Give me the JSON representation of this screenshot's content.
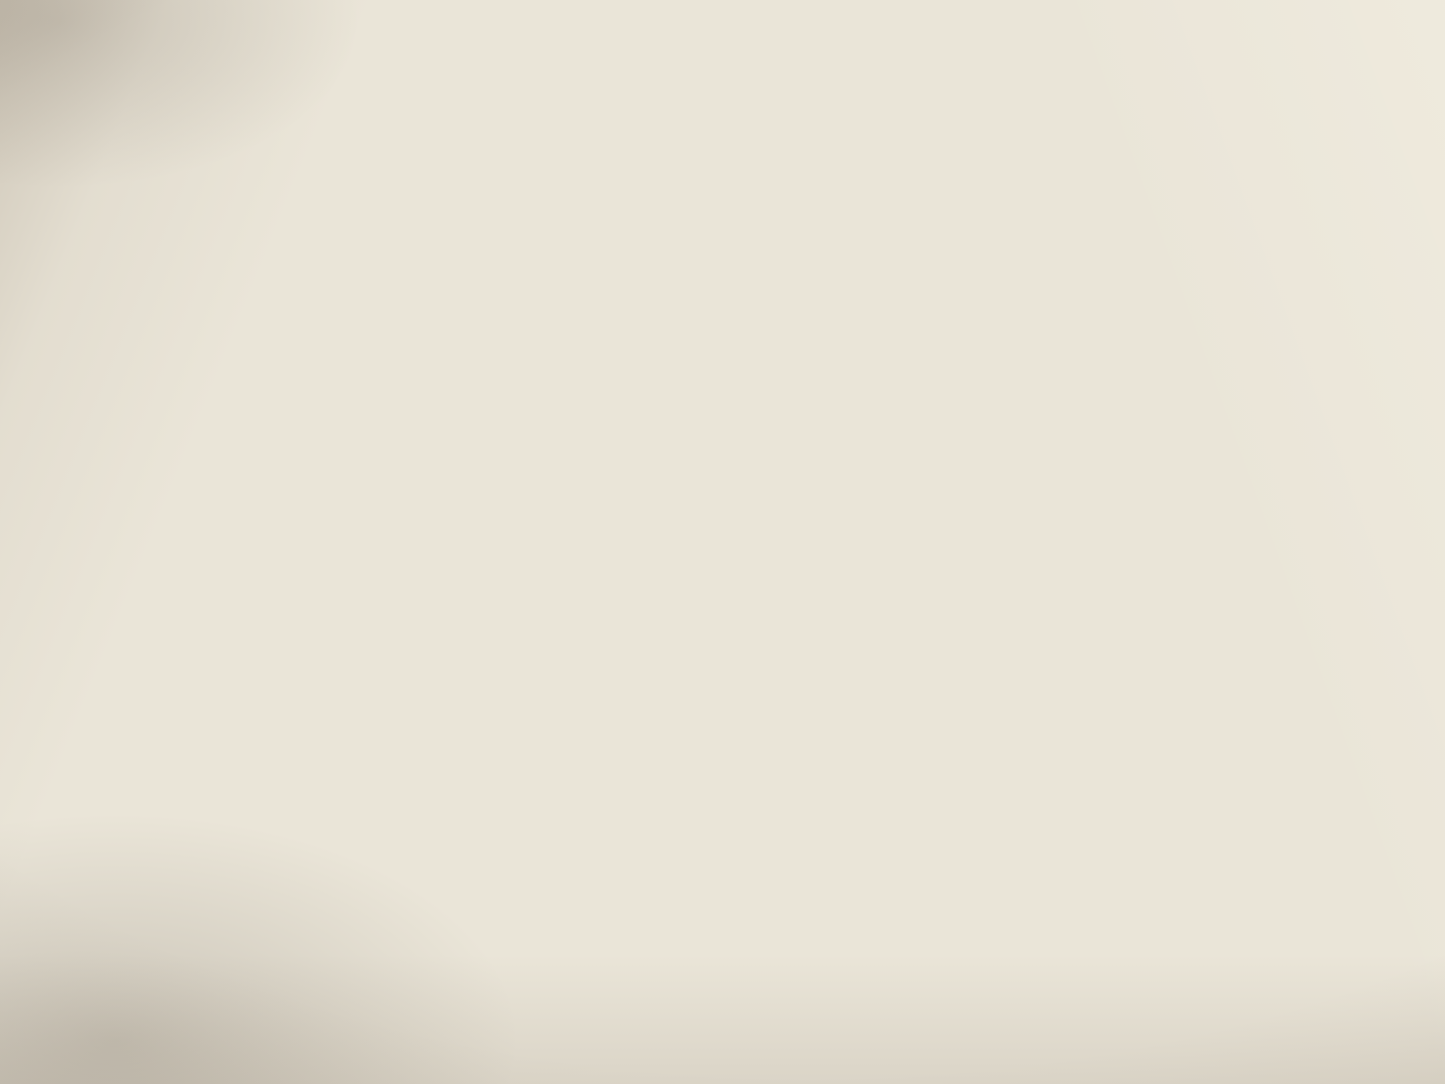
{
  "palette": {
    "paper": "#eae5d8",
    "ink": "#2b2722",
    "contour": "#9d5c3a",
    "contour_light": "#b98e6a",
    "water": "#46719c",
    "water_fill": "#a3bed2",
    "elevation_red": "#93401f"
  },
  "map": {
    "type": "topographic-quadrangle",
    "city_name": "MACOMB",
    "labels": [
      {
        "id": "township-letter-m1",
        "kind": "township",
        "text": "M",
        "x": 41,
        "y": 138,
        "size": 62
      },
      {
        "id": "township-letter-m2",
        "kind": "township",
        "text": "M",
        "x": 194,
        "y": 142,
        "size": 62
      },
      {
        "id": "township-letter-e",
        "kind": "township",
        "text": "E",
        "x": 350,
        "y": 139,
        "size": 60
      },
      {
        "id": "township-letter-t",
        "kind": "township",
        "text": "T",
        "x": 503,
        "y": 136,
        "size": 62
      },
      {
        "id": "township-letter-m3",
        "kind": "township",
        "text": "M",
        "x": 1016,
        "y": 176,
        "size": 64
      },
      {
        "id": "township-letter-a",
        "kind": "township",
        "text": "A",
        "x": 1224,
        "y": 179,
        "size": 64
      },
      {
        "id": "township-letter-c",
        "kind": "township",
        "text": "C",
        "x": 1432,
        "y": 181,
        "size": 64
      },
      {
        "id": "section-27",
        "kind": "section",
        "text": "27",
        "x": 70,
        "y": 202,
        "size": 29
      },
      {
        "id": "section-26",
        "kind": "section",
        "text": "26",
        "x": 274,
        "y": 188,
        "size": 29
      },
      {
        "id": "section-25",
        "kind": "section",
        "text": "25",
        "x": 609,
        "y": 212,
        "size": 29
      },
      {
        "id": "section-30",
        "kind": "section",
        "text": "30",
        "x": 871,
        "y": 211,
        "size": 29
      },
      {
        "id": "section-29",
        "kind": "section",
        "text": "29",
        "x": 1135,
        "y": 208,
        "size": 29
      },
      {
        "id": "section-28",
        "kind": "section",
        "text": "28",
        "x": 1418,
        "y": 217,
        "size": 29
      },
      {
        "id": "section-34",
        "kind": "section",
        "text": "34",
        "x": 27,
        "y": 490,
        "size": 29
      },
      {
        "id": "section-35",
        "kind": "section",
        "text": "35",
        "x": 283,
        "y": 494,
        "size": 29
      },
      {
        "id": "section-36",
        "kind": "section",
        "text": "36",
        "x": 535,
        "y": 508,
        "size": 29
      },
      {
        "id": "section-32",
        "kind": "section",
        "text": "32",
        "x": 1155,
        "y": 475,
        "size": 29
      },
      {
        "id": "section-33",
        "kind": "section",
        "text": "33",
        "x": 1398,
        "y": 481,
        "size": 29
      },
      {
        "id": "section-3",
        "kind": "section",
        "text": "3",
        "x": 13,
        "y": 740,
        "size": 29
      },
      {
        "id": "section-2",
        "kind": "section",
        "text": "2",
        "x": 308,
        "y": 742,
        "size": 29
      },
      {
        "id": "section-1",
        "kind": "section",
        "text": "1",
        "x": 571,
        "y": 751,
        "size": 29
      },
      {
        "id": "section-6",
        "kind": "section",
        "text": "6",
        "x": 884,
        "y": 747,
        "size": 29
      },
      {
        "id": "section-5",
        "kind": "section",
        "text": "5",
        "x": 1148,
        "y": 750,
        "size": 29
      },
      {
        "id": "section-4",
        "kind": "section",
        "text": "4",
        "x": 1417,
        "y": 725,
        "size": 29
      },
      {
        "id": "section-10",
        "kind": "section",
        "text": "10",
        "x": 47,
        "y": 1018,
        "size": 27
      },
      {
        "id": "section-11",
        "kind": "section",
        "text": "11",
        "x": 308,
        "y": 1036,
        "size": 27
      },
      {
        "id": "section-12",
        "kind": "section",
        "text": "12",
        "x": 592,
        "y": 1038,
        "size": 27
      },
      {
        "id": "section-7",
        "kind": "section",
        "text": "7",
        "x": 870,
        "y": 1015,
        "size": 27
      },
      {
        "id": "section-8",
        "kind": "section",
        "text": "8",
        "x": 1143,
        "y": 1022,
        "size": 27
      },
      {
        "id": "section-9",
        "kind": "section",
        "text": "9",
        "x": 1408,
        "y": 1018,
        "size": 27
      },
      {
        "id": "elevation-717",
        "kind": "elev-red",
        "text": "717",
        "x": 477,
        "y": 60,
        "size": 20
      },
      {
        "id": "elevation-653",
        "kind": "elev-red",
        "text": "653",
        "x": 755,
        "y": 70,
        "size": 20
      },
      {
        "id": "elevation-700-ne",
        "kind": "elev-red",
        "text": "700",
        "x": 1283,
        "y": 96,
        "size": 20
      },
      {
        "id": "elevation-600-pond",
        "kind": "elev-red",
        "text": "600",
        "x": 875,
        "y": 155,
        "size": 19
      },
      {
        "id": "elevation-700-hill",
        "kind": "elev-red",
        "text": "700",
        "x": 1096,
        "y": 192,
        "size": 19
      },
      {
        "id": "elevation-600-creek",
        "kind": "elev-red",
        "text": "600",
        "x": 296,
        "y": 282,
        "size": 19
      },
      {
        "id": "elevation-679-n",
        "kind": "elev-red",
        "text": "679",
        "x": 826,
        "y": 300,
        "size": 19
      },
      {
        "id": "elevation-700-w",
        "kind": "elev-red",
        "text": "700",
        "x": 38,
        "y": 300,
        "size": 19,
        "rot": -70
      },
      {
        "id": "elevation-694",
        "kind": "elev-red",
        "text": "694",
        "x": 1291,
        "y": 542,
        "size": 19
      },
      {
        "id": "elevation-700-sw",
        "kind": "elev-red",
        "text": "700",
        "x": 492,
        "y": 589,
        "size": 19,
        "rot": -48
      },
      {
        "id": "elevation-687",
        "kind": "elev-red",
        "text": "687",
        "x": 58,
        "y": 722,
        "size": 19
      },
      {
        "id": "elevation-678",
        "kind": "elev-red",
        "text": "678",
        "x": 336,
        "y": 815,
        "size": 19
      },
      {
        "id": "elevation-679-s",
        "kind": "elev-red",
        "text": "679",
        "x": 616,
        "y": 755,
        "size": 19
      },
      {
        "id": "elevation-700-s1",
        "kind": "elev-red",
        "text": "700",
        "x": 1098,
        "y": 721,
        "size": 19
      },
      {
        "id": "elevation-700-s2",
        "kind": "elev-red",
        "text": "700",
        "x": 1031,
        "y": 750,
        "size": 19
      },
      {
        "id": "elevation-697",
        "kind": "elev-red",
        "text": "697",
        "x": 757,
        "y": 1012,
        "size": 19
      },
      {
        "id": "elevation-693",
        "kind": "elev-red",
        "text": "693",
        "x": 1030,
        "y": 1026,
        "size": 19
      },
      {
        "id": "elevation-631",
        "kind": "elev-red",
        "text": "631",
        "x": 1305,
        "y": 1032,
        "size": 19
      },
      {
        "id": "elevation-600-road",
        "kind": "elev-black",
        "text": "600",
        "x": 191,
        "y": 490,
        "size": 21
      },
      {
        "id": "elevation-691",
        "kind": "elev-black",
        "text": "691",
        "x": 1412,
        "y": 365,
        "size": 20
      },
      {
        "id": "elevation-703",
        "kind": "elev-black",
        "text": "703",
        "x": 440,
        "y": 563,
        "size": 22
      },
      {
        "id": "benchmark-bm-west",
        "kind": "bm",
        "text": "B M",
        "x": 330,
        "y": 469,
        "size": 17
      },
      {
        "id": "benchmark-696-west",
        "kind": "bm",
        "text": "696",
        "x": 390,
        "y": 496,
        "size": 20
      },
      {
        "id": "benchmark-696-east",
        "kind": "bm",
        "text": "B M 696",
        "x": 1263,
        "y": 343,
        "size": 19
      },
      {
        "id": "benchmark-702",
        "kind": "bm",
        "text": "B M 702",
        "x": 579,
        "y": 429,
        "size": 19
      },
      {
        "id": "place-maguire-1",
        "kind": "place",
        "text": "Maguire",
        "x": 1317,
        "y": 286,
        "size": 21
      },
      {
        "id": "place-maguire-2",
        "kind": "place",
        "text": "School",
        "x": 1311,
        "y": 306,
        "size": 21
      },
      {
        "id": "place-brickyard-1",
        "kind": "place",
        "text": "Brickyard",
        "x": 253,
        "y": 439,
        "size": 22
      },
      {
        "id": "place-brickyard-2",
        "kind": "place",
        "text": "School",
        "x": 235,
        "y": 457,
        "size": 22
      },
      {
        "id": "place-normal-1",
        "kind": "place",
        "text": "Normal",
        "x": 550,
        "y": 451,
        "size": 22,
        "rot": -8
      },
      {
        "id": "place-normal-2",
        "kind": "place",
        "text": "School",
        "x": 553,
        "y": 471,
        "size": 22,
        "rot": -5
      },
      {
        "id": "place-macomb",
        "kind": "place-caps",
        "text": "MACOMB",
        "x": 1111,
        "y": 506,
        "size": 31
      },
      {
        "id": "place-fairmont",
        "kind": "place",
        "text": "Fairmont School",
        "x": 1128,
        "y": 885,
        "size": 21
      },
      {
        "id": "place-harmony",
        "kind": "place",
        "text": "Harmony School",
        "x": 562,
        "y": 987,
        "size": 21
      },
      {
        "id": "water-crooked",
        "kind": "water",
        "text": "Crooked",
        "x": 545,
        "y": 185,
        "size": 24,
        "rot": -27
      },
      {
        "id": "water-creek-n",
        "kind": "water",
        "text": "Creek",
        "x": 958,
        "y": 70,
        "size": 24,
        "rot": -54
      },
      {
        "id": "water-wigwam",
        "kind": "water",
        "text": "Wigwam",
        "x": 308,
        "y": 112,
        "size": 18,
        "rot": 74
      },
      {
        "id": "water-hollow",
        "kind": "water",
        "text": "Hollow",
        "x": 348,
        "y": 240,
        "size": 18,
        "rot": 74
      },
      {
        "id": "water-fork",
        "kind": "water",
        "text": "Fork",
        "x": 170,
        "y": 320,
        "size": 20,
        "rot": -30
      },
      {
        "id": "water-creek-sw",
        "kind": "water",
        "text": "Creek",
        "x": 92,
        "y": 1030,
        "size": 20,
        "rot": -65
      },
      {
        "id": "railroad-chicago",
        "kind": "rail",
        "text": "CHICAGO",
        "x": 1198,
        "y": 376,
        "size": 15,
        "rot": -14
      },
      {
        "id": "railroad-bu",
        "kind": "rail",
        "text": "BU",
        "x": 1424,
        "y": 312,
        "size": 15,
        "rot": -16
      }
    ]
  }
}
